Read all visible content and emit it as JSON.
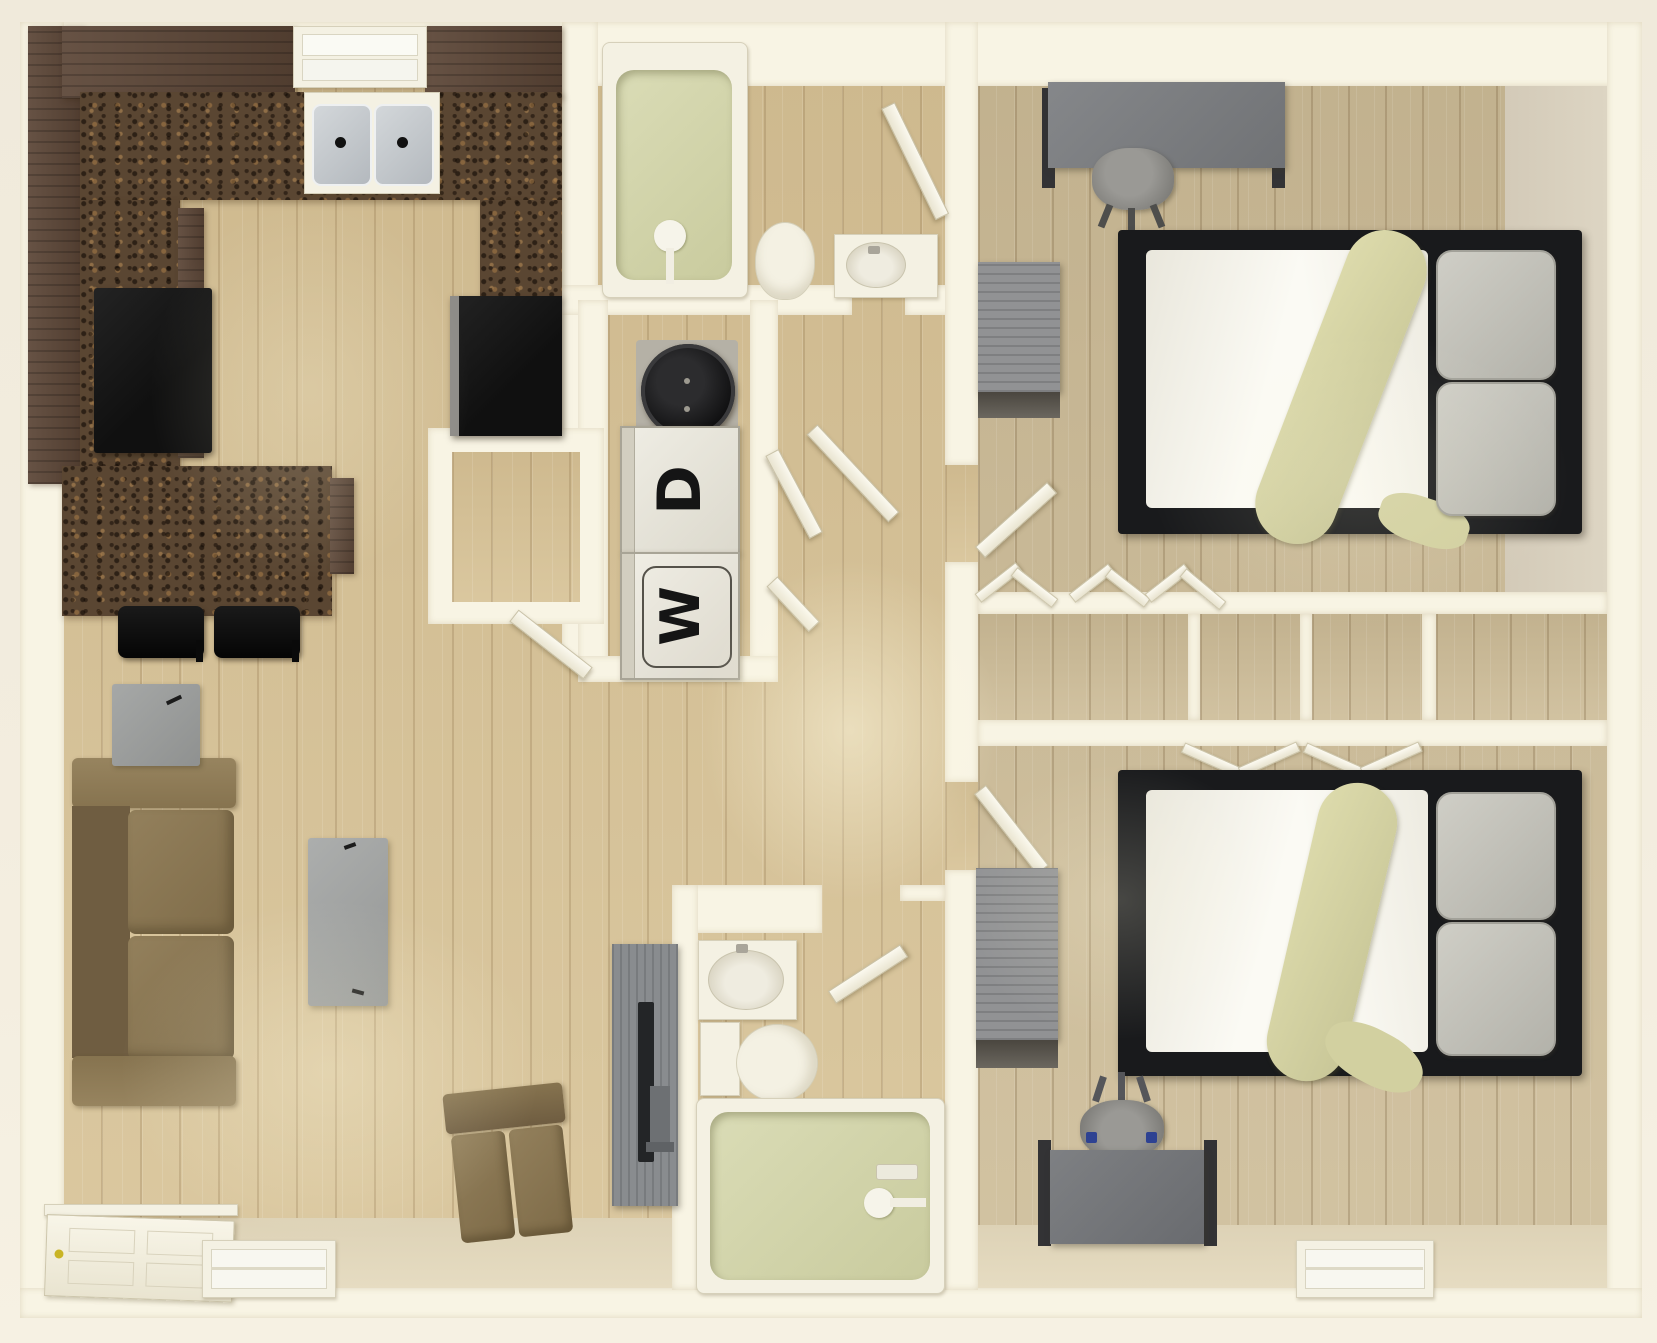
{
  "floorplan": {
    "view": "3d-top-down-apartment-floor-plan",
    "laundry": {
      "dryer_label": "D",
      "washer_label": "W"
    },
    "rooms": [
      "kitchen",
      "living-room",
      "entry",
      "bathroom-main",
      "laundry-closet",
      "pantry",
      "hallway",
      "bedroom-top",
      "bedroom-bottom",
      "closets",
      "bathroom-second"
    ],
    "fixtures": [
      "double-sink",
      "window",
      "refrigerator",
      "range",
      "breakfast-bar",
      "bar-stools",
      "water-heater",
      "stacked-washer-dryer",
      "bathtub",
      "toilet",
      "vanity-sink",
      "sofa",
      "armchair",
      "coffee-table",
      "end-table",
      "tv-panel",
      "entry-door",
      "bed",
      "desk",
      "office-chair",
      "dresser",
      "bifold-closet-doors"
    ],
    "colors": {
      "background": "#f1ebdc",
      "wall": "#f8f4e4",
      "wood_floor": "#d8c499",
      "bedroom_wood_floor": "#cfbf9c",
      "tan_floor": "#ddd2b6",
      "greige_floor": "#d5ccba",
      "cabinet_brown": "#5b4536",
      "granite_counter": "#5a4632",
      "appliance_black": "#161616",
      "fixture_white": "#f4f1e3",
      "tub_sage": "#d3d4ab",
      "sofa_brown": "#8d7a58",
      "gray_furniture": "#919294",
      "bed_frame_black": "#191a1c",
      "bedding_white": "#fbfaf4",
      "throw_sage": "#d7d5a5",
      "pillow_gray": "#c4c3bb",
      "door_white": "#f7f4e6",
      "door_knob_yellow": "#c9b425"
    }
  }
}
